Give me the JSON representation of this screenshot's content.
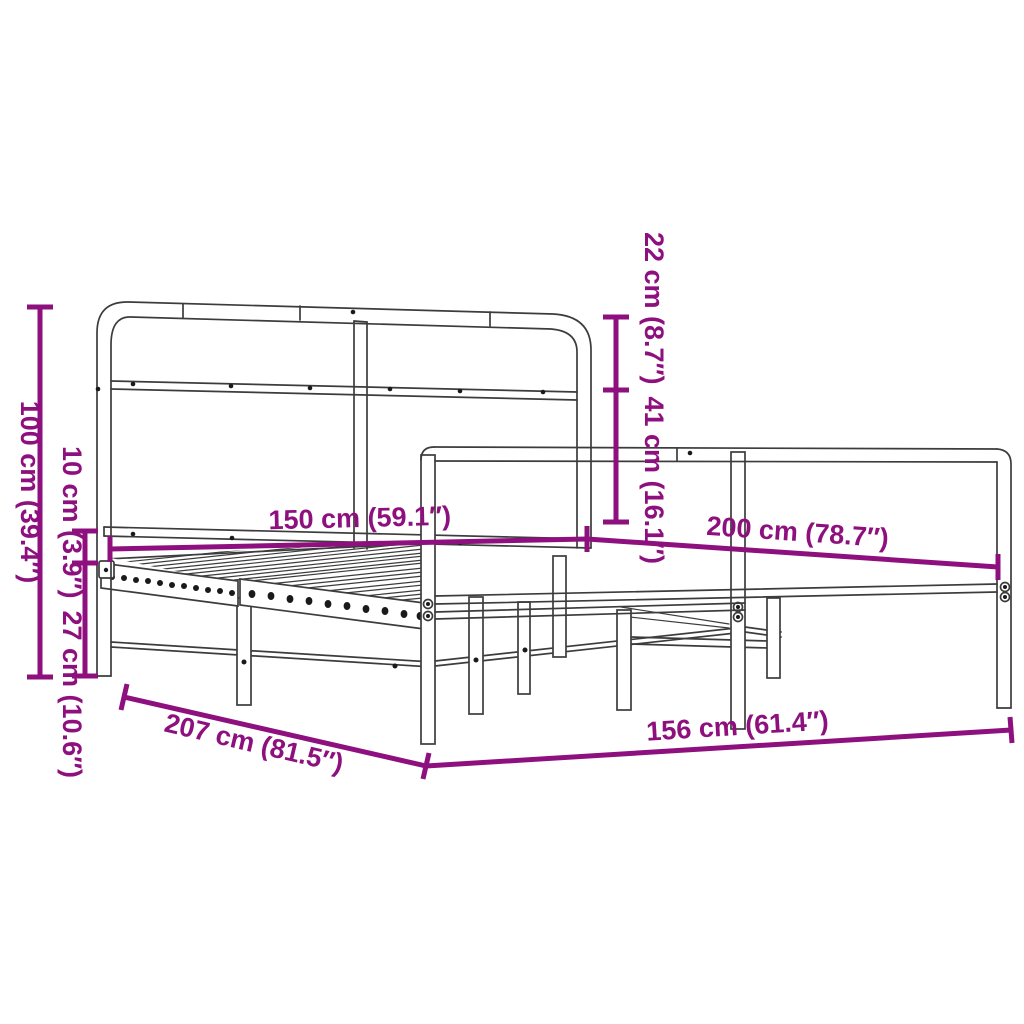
{
  "diagram": {
    "product": "metal-bed-frame-with-headboard-and-footboard",
    "background": "#FFFFFF",
    "line_color": "#3C3C3C",
    "accent_color": "#8E107E",
    "dimensions": {
      "total_height": "100 cm (39.4″)",
      "side_rail_height": "10 cm (3.9″)",
      "under_bed_clearance": "27 cm (10.6″)",
      "headboard_top_to_rail": "22 cm (8.7″)",
      "headboard_above_base": "41 cm (16.1″)",
      "inner_width": "150 cm (59.1″)",
      "inner_length": "200 cm (78.7″)",
      "outer_length": "207 cm (81.5″)",
      "outer_width": "156 cm (61.4″)"
    }
  }
}
